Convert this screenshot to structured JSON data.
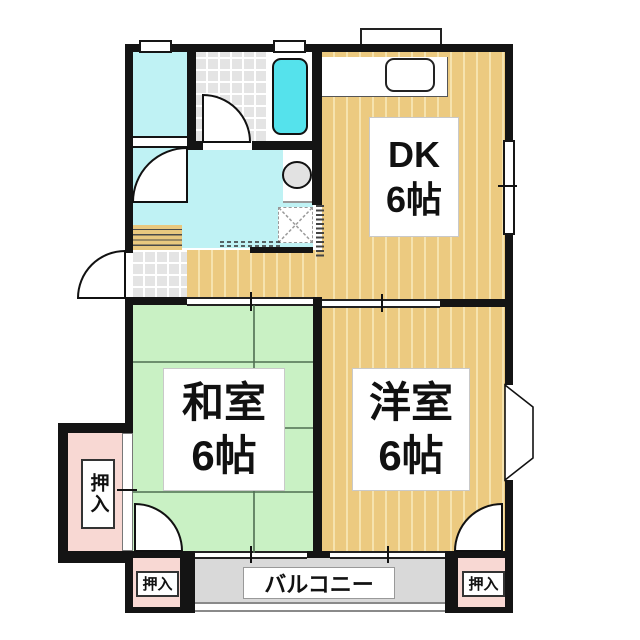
{
  "plan": {
    "title": "apartment floor plan",
    "rooms": {
      "dk": {
        "name": "DK",
        "size": "6帖"
      },
      "washitsu": {
        "name": "和室",
        "size": "6帖"
      },
      "youshitsu": {
        "name": "洋室",
        "size": "6帖"
      }
    },
    "balcony": {
      "label": "バルコニー"
    },
    "closets": {
      "left": {
        "label": "押入"
      },
      "bottom_left": {
        "label": "押入"
      },
      "bottom_right": {
        "label": "押入"
      }
    },
    "colors": {
      "wall": "#141414",
      "wood_floor": "#ecca80",
      "tatami": "#c9f1c4",
      "water_area": "#bff2f4",
      "bathtub": "#55e2ec",
      "tile": "#e4e4e4",
      "closet_pink": "#f8d8d3",
      "balcony_grey": "#d9d9d9"
    }
  }
}
